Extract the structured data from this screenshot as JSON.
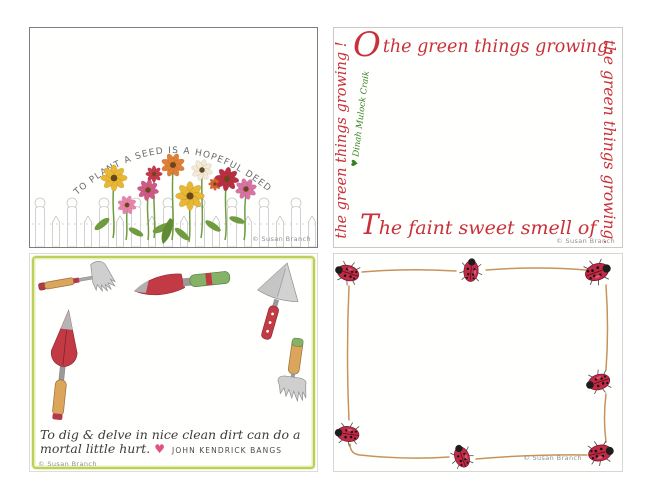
{
  "cards": {
    "seed": {
      "arc_text": "TO PLANT A SEED IS A HOPEFUL DEED",
      "signature": "© Susan Branch"
    },
    "green_things": {
      "initial": "O",
      "top_rest": "the green things growing.",
      "left_text": "the green things growing !",
      "attribution": "♥ Dinah Mulock Craik",
      "right_text": "the green things growing.",
      "bottom_text": "The faint sweet smell of",
      "signature": "© Susan Branch"
    },
    "garden_tools": {
      "quote_line1": "To dig & delve in nice clean dirt can do a",
      "quote_line2": "mortal  little hurt.",
      "heart": "♥",
      "attribution": "JOHN KENDRICK BANGS",
      "signature": "© Susan Branch"
    },
    "ladybugs": {
      "signature": "© Susan Branch"
    }
  },
  "colors": {
    "script_red": "#c9303a",
    "attribution_green": "#35801f",
    "watercolor_border_green": "#becf58",
    "ladybug_red": "#c22b45",
    "twig_line_tan": "#c8935a",
    "tool_handle_wood": "#dba55c",
    "tool_handle_green": "#86b268"
  }
}
